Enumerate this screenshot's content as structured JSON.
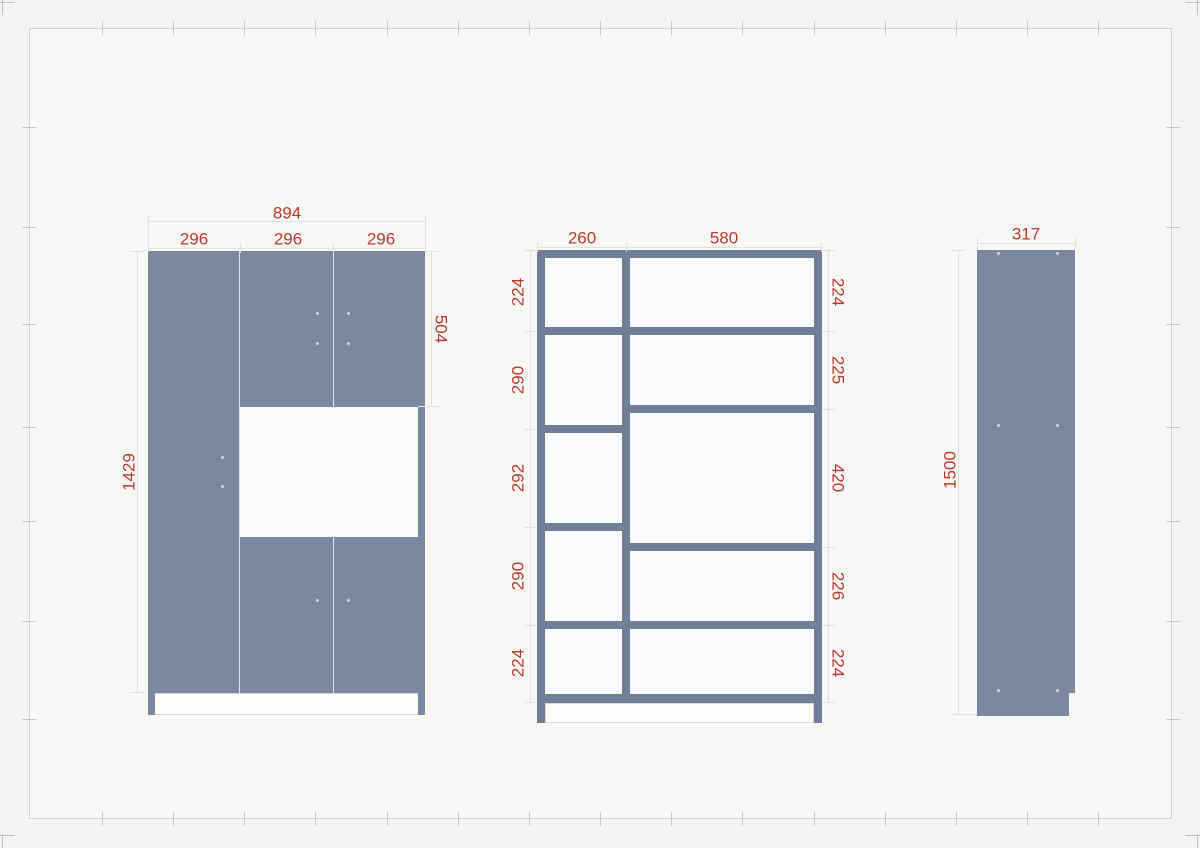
{
  "colors": {
    "panel": "#7a89a0",
    "frame": "#6e7f96",
    "dimension_text": "#bd3a2c"
  },
  "front_view": {
    "overall_width": "894",
    "section_widths": [
      "296",
      "296",
      "296"
    ],
    "body_height": "1429",
    "upper_door_height": "504"
  },
  "carcass_view": {
    "left_column_width": "260",
    "right_column_width": "580",
    "left_row_heights": [
      "224",
      "290",
      "292",
      "290",
      "224"
    ],
    "right_row_heights": [
      "224",
      "225",
      "420",
      "226",
      "224"
    ]
  },
  "side_view": {
    "depth": "317",
    "total_height": "1500"
  }
}
